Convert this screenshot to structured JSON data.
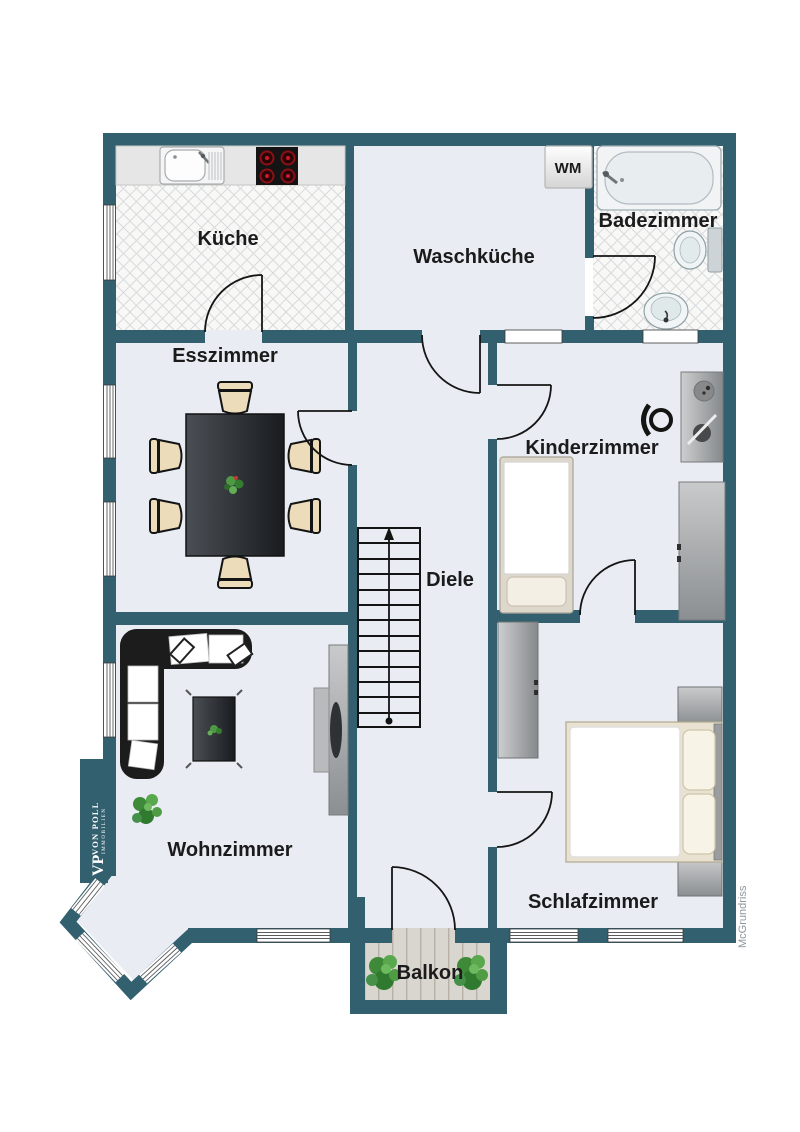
{
  "rooms": [
    {
      "id": "kueche",
      "label": "Küche"
    },
    {
      "id": "waschkueche",
      "label": "Waschküche"
    },
    {
      "id": "badezimmer",
      "label": "Badezimmer"
    },
    {
      "id": "esszimmer",
      "label": "Esszimmer"
    },
    {
      "id": "kinderzimmer",
      "label": "Kinderzimmer"
    },
    {
      "id": "diele",
      "label": "Diele"
    },
    {
      "id": "wohnzimmer",
      "label": "Wohnzimmer"
    },
    {
      "id": "schlafzimmer",
      "label": "Schlafzimmer"
    },
    {
      "id": "balkon",
      "label": "Balkon"
    }
  ],
  "appliances": {
    "washing_machine": "WM"
  },
  "stairs": {
    "steps": 13,
    "direction": "up"
  },
  "branding": {
    "vp": "VP",
    "von_poll": "VON POLL",
    "immobilien": "IMMOBILIEN",
    "watermark": "McGrundriss"
  },
  "colors": {
    "wall": "#33606F",
    "floor": "#E9EDF3",
    "tile_bg": "#F8F8F7",
    "tile_line": "#D9DADC",
    "wood": "#D9D5CF",
    "wood_line": "#B7B0A7",
    "burner_red": "#C41426",
    "plant_green": "#4E9A44",
    "label": "#1B1B1B",
    "watermark": "#8D979C"
  }
}
